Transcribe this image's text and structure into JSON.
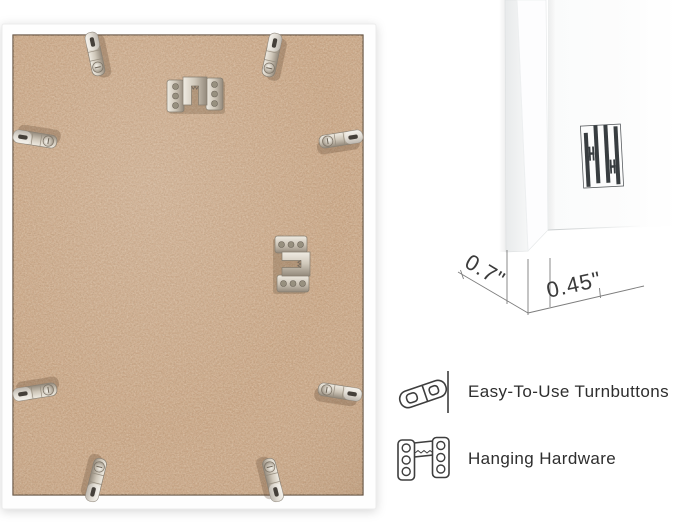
{
  "page": {
    "background": "#ffffff"
  },
  "dimensions": {
    "depth_label": "0.7\"",
    "face_label": "0.45\""
  },
  "legend": {
    "items": [
      {
        "icon": "turnbutton-icon",
        "label": "Easy-To-Use Turnbuttons"
      },
      {
        "icon": "hanging-hardware-icon",
        "label": "Hanging Hardware"
      }
    ]
  },
  "hardware_visible": {
    "turnbutton_count": 8,
    "hanging_hardware_count": 2
  },
  "icons": {
    "turnbutton": "turnbutton-icon",
    "hanging_hardware": "hanging-hardware-icon",
    "brand": "brand-logo-double-h-bars"
  },
  "colors": {
    "backing_board": "#c9a585",
    "backing_edge": "#5f4c3a",
    "frame": "#fefefe",
    "metal": "#cfc7b9",
    "logo": "#383d40",
    "dimension_line": "#7d7d7d",
    "text": "#2e2e2e"
  }
}
